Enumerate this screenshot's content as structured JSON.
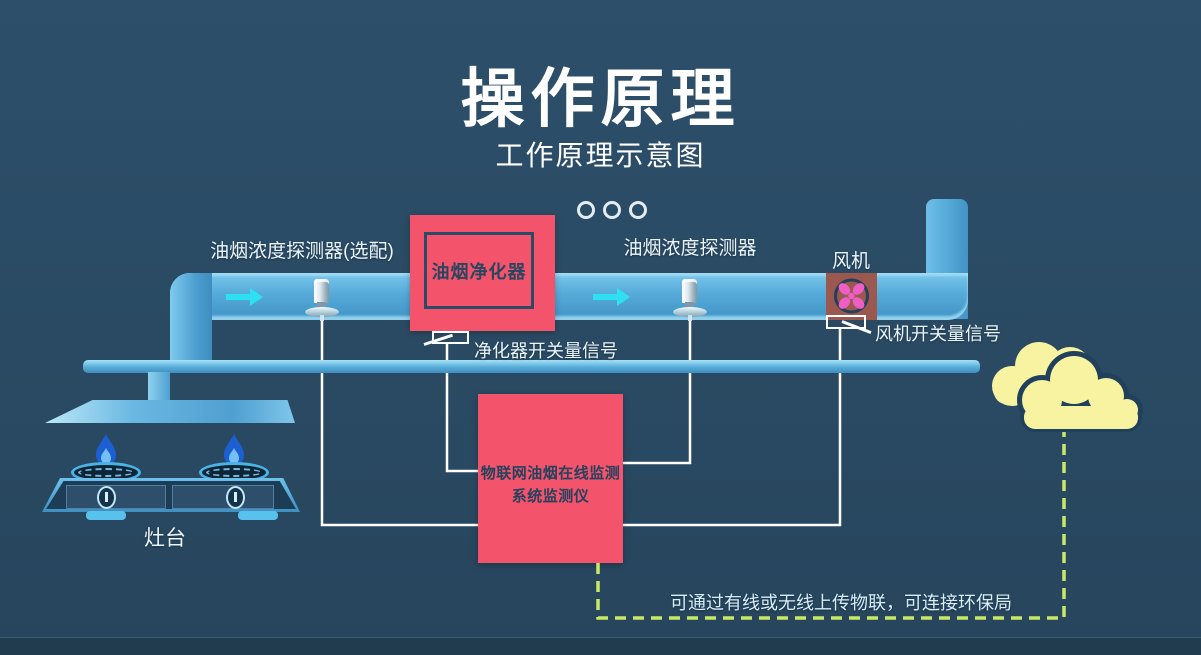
{
  "title": "操作原理",
  "subtitle": "工作原理示意图",
  "labels": {
    "detector_optional": "油烟浓度探测器(选配)",
    "detector": "油烟浓度探测器",
    "purifier": "油烟净化器",
    "purifier_signal": "净化器开关量信号",
    "fan": "风机",
    "fan_signal": "风机开关量信号",
    "stove": "灶台",
    "monitor_line1": "物联网油烟在线监测",
    "monitor_line2": "系统监测仪",
    "upload_note": "可通过有线或无线上传物联，可连接环保局"
  },
  "colors": {
    "background": "#2a4a63",
    "duct_blue": "#55aad8",
    "accent_red": "#f3536b",
    "arrow_cyan": "#2fe0f2",
    "cloud_yellow": "#f7f3a1",
    "dashed_green": "#c8e966",
    "navy_text": "#24425d",
    "fan_brown": "#9a584e",
    "fan_petal_pink": "#ee5fc4",
    "flame_blue": "#1b5fd2",
    "wire_white": "#ffffff"
  }
}
